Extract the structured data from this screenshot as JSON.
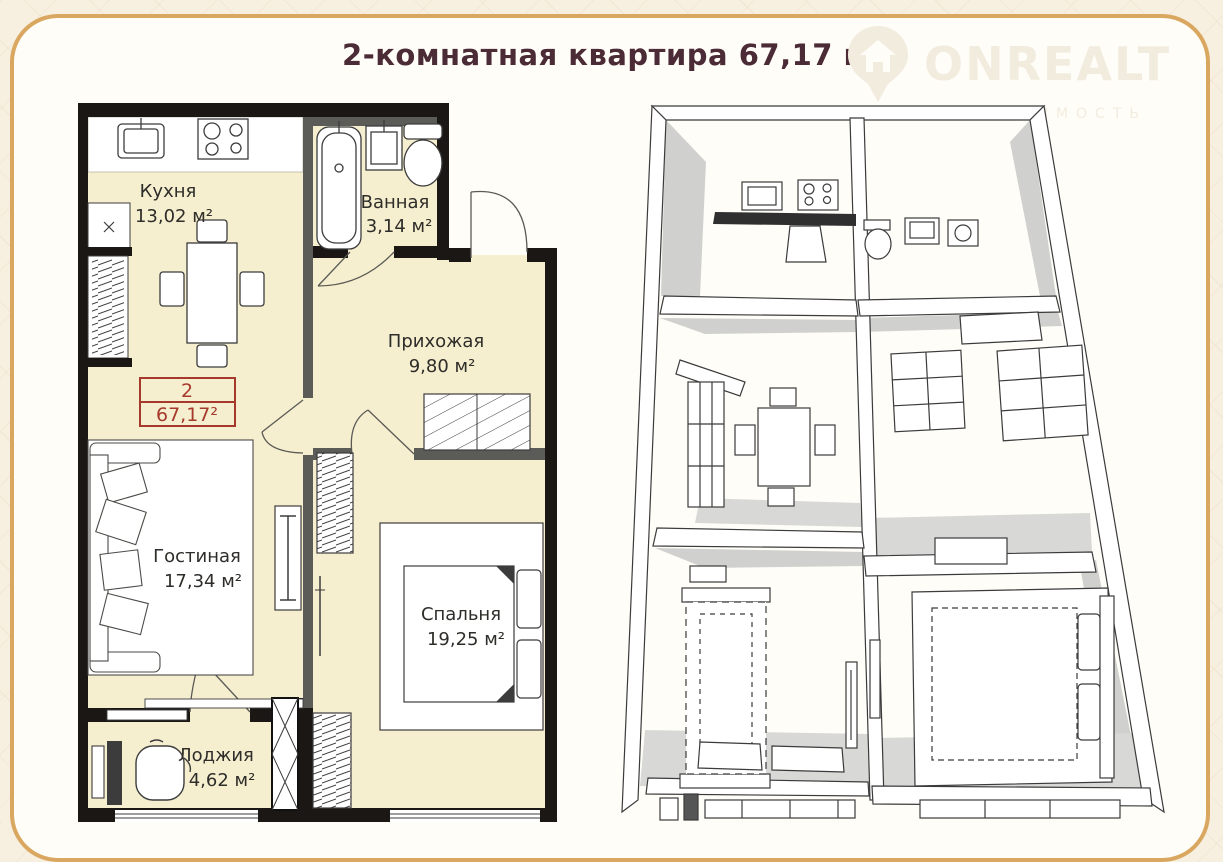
{
  "page": {
    "title": "2-комнатная квартира 67,17 м²"
  },
  "logo": {
    "brand": "ONREALT",
    "subtitle": "НЕДВИЖИМОСТЬ",
    "icon": "house-pin-icon"
  },
  "apartment_label": {
    "number": "2",
    "area": "67,17²"
  },
  "rooms": [
    {
      "id": "kitchen",
      "name": "Кухня",
      "area": "13,02 м²"
    },
    {
      "id": "bathroom",
      "name": "Ванная",
      "area": "3,14 м²"
    },
    {
      "id": "hallway",
      "name": "Прихожая",
      "area": "9,80 м²"
    },
    {
      "id": "living",
      "name": "Гостиная",
      "area": "17,34 м²"
    },
    {
      "id": "bedroom",
      "name": "Спальня",
      "area": "19,25 м²"
    },
    {
      "id": "loggia",
      "name": "Лоджия",
      "area": "4,62 м²"
    }
  ],
  "views": {
    "left": "2D план",
    "right": "3D аксонометрия"
  },
  "colors": {
    "card_border": "#d9a75f",
    "title_text": "#4b2b36",
    "floor_fill": "#f5eecf",
    "exterior_wall": "#1a1714",
    "partition_wall": "#5b5b58",
    "apartment_label": "#a53a2c"
  }
}
